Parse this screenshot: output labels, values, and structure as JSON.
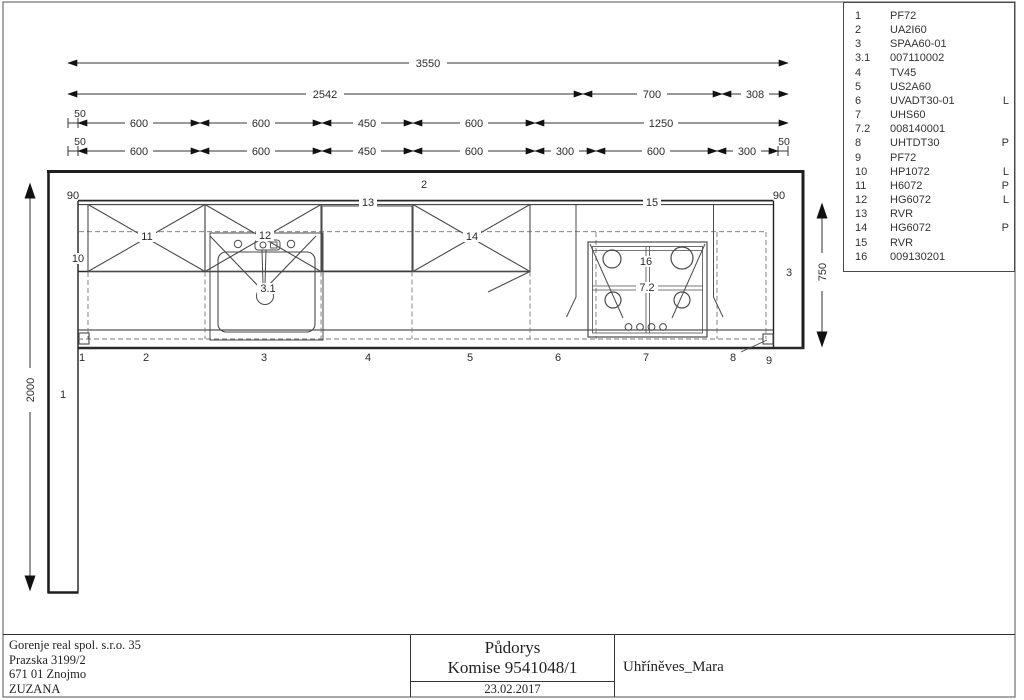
{
  "sheet": {
    "type_label": "kitchen floor plan drawing"
  },
  "dims": {
    "total": "3550",
    "row2": [
      "2542",
      "700",
      "308"
    ],
    "row3": [
      "50",
      "600",
      "600",
      "450",
      "600",
      "1250"
    ],
    "row4": [
      "50",
      "600",
      "600",
      "450",
      "600",
      "300",
      "600",
      "300",
      "50"
    ],
    "left_wall": "2000",
    "right_wall": "750",
    "offset_left": "90",
    "offset_right": "90"
  },
  "plan": {
    "wall_left": "1",
    "wall_top": "2",
    "wall_right": "3",
    "cornice": "10",
    "wall_cabinet_left": "11",
    "wall_cabinet_sink": "12",
    "shelf_left": "13",
    "wall_cabinet_right": "14",
    "shelf_right": "15",
    "hob": "16",
    "hob_grid": "7.2",
    "sink_drain": "3.1",
    "positions": [
      "1",
      "2",
      "3",
      "4",
      "5",
      "6",
      "7",
      "8",
      "9"
    ]
  },
  "parts": [
    {
      "no": "1",
      "code": "PF72",
      "side": ""
    },
    {
      "no": "2",
      "code": "UA2I60",
      "side": ""
    },
    {
      "no": "3",
      "code": "SPAA60-01",
      "side": ""
    },
    {
      "no": "3.1",
      "code": "007110002",
      "side": ""
    },
    {
      "no": "4",
      "code": "TV45",
      "side": ""
    },
    {
      "no": "5",
      "code": "US2A60",
      "side": ""
    },
    {
      "no": "6",
      "code": "UVADT30-01",
      "side": "L"
    },
    {
      "no": "7",
      "code": "UHS60",
      "side": ""
    },
    {
      "no": "7.2",
      "code": "008140001",
      "side": ""
    },
    {
      "no": "8",
      "code": "UHTDT30",
      "side": "P"
    },
    {
      "no": "9",
      "code": "PF72",
      "side": ""
    },
    {
      "no": "10",
      "code": "HP1072",
      "side": "L"
    },
    {
      "no": "11",
      "code": "H6072",
      "side": "P"
    },
    {
      "no": "12",
      "code": "HG6072",
      "side": "L"
    },
    {
      "no": "13",
      "code": "RVR",
      "side": ""
    },
    {
      "no": "14",
      "code": "HG6072",
      "side": "P"
    },
    {
      "no": "15",
      "code": "RVR",
      "side": ""
    },
    {
      "no": "16",
      "code": "009130201",
      "side": ""
    }
  ],
  "title_block": {
    "company_lines": [
      "Gorenje real spol. s.r.o. 35",
      "Prazska 3199/2",
      "671 01 Znojmo",
      "ZUZANA"
    ],
    "drawing_type": "Půdorys",
    "commission": "Komise 9541048/1",
    "date": "23.02.2017",
    "project": "Uhříněves_Mara"
  },
  "colors": {
    "line": "#333333",
    "dashed": "#777777",
    "text": "#2b2b2b",
    "background": "#ffffff"
  }
}
